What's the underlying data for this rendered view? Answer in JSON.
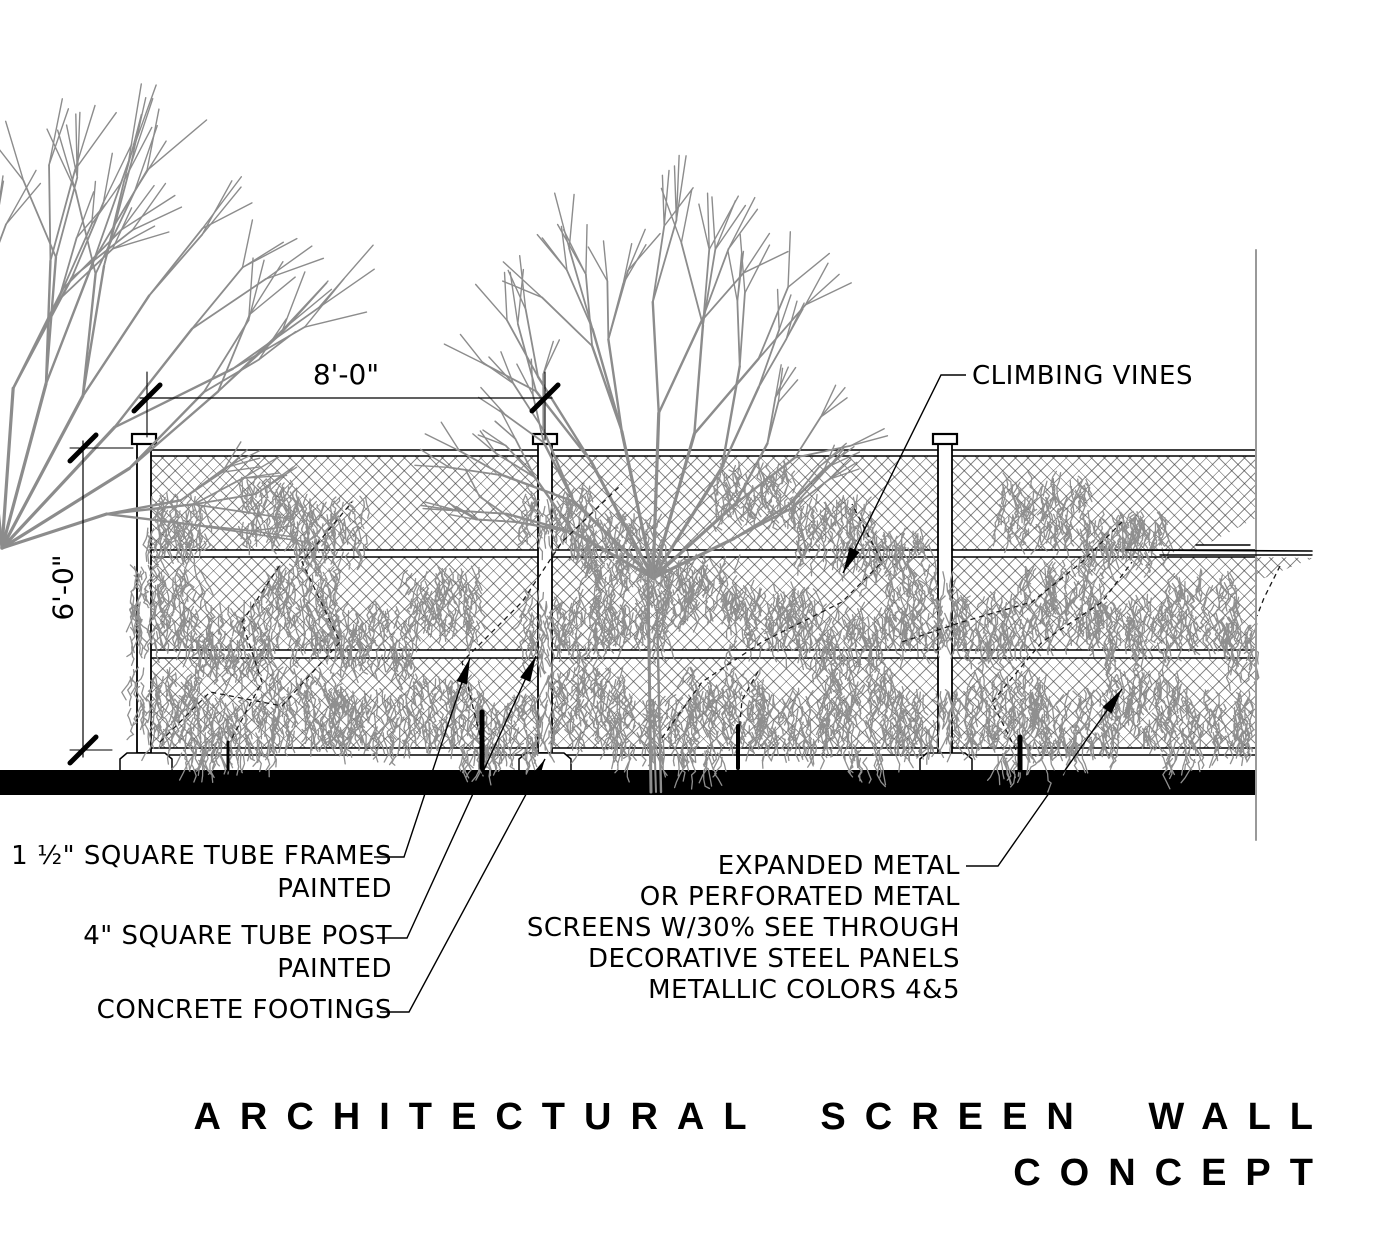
{
  "drawing": {
    "title_line1": "ARCHITECTURAL SCREEN WALL",
    "title_line2": "CONCEPT",
    "dimensions": {
      "panel_width": "8'-0\"",
      "fence_height": "6'-0\""
    },
    "callouts": {
      "climbing_vines": "CLIMBING VINES",
      "tube_frames_line1": "1 ½\" SQUARE TUBE FRAMES",
      "tube_frames_line2": "PAINTED",
      "tube_post_line1": "4\" SQUARE TUBE POST",
      "tube_post_line2": "PAINTED",
      "concrete_footings": "CONCRETE FOOTINGS",
      "screen_line1": "EXPANDED METAL",
      "screen_line2": "OR PERFORATED METAL",
      "screen_line3": "SCREENS W/30% SEE THROUGH",
      "screen_line4": "DECORATIVE STEEL PANELS",
      "screen_line5": "METALLIC COLORS 4&5"
    },
    "colors": {
      "ink": "#000000",
      "tree_gray": "#8c8c8c",
      "vine_gray": "#8f8f8f",
      "mesh_gray": "#2d2d2d",
      "ground_black": "#000000"
    }
  }
}
